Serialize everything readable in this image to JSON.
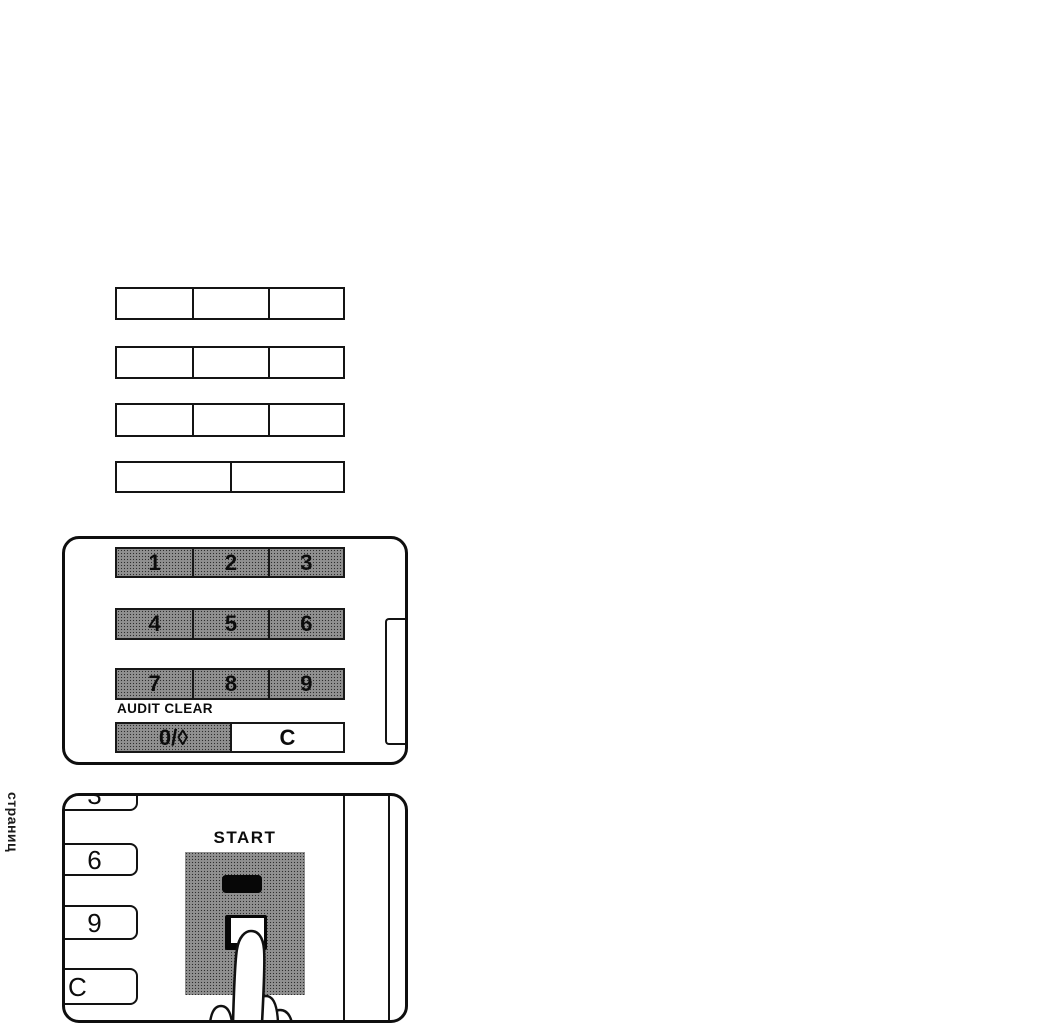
{
  "page": {
    "side_label": "страниц"
  },
  "blank_tables": {
    "rows": [
      {
        "cells": 3
      },
      {
        "cells": 3
      },
      {
        "cells": 3
      },
      {
        "cells": 2
      }
    ]
  },
  "keypad_panel": {
    "digits": [
      [
        "1",
        "2",
        "3"
      ],
      [
        "4",
        "5",
        "6"
      ],
      [
        "7",
        "8",
        "9"
      ]
    ],
    "audit_clear_label": "AUDIT CLEAR",
    "zero_key_label": "0/◊",
    "clear_key_label": "C"
  },
  "start_panel": {
    "title": "START",
    "side_keys": [
      "3",
      "6",
      "9",
      "C"
    ]
  },
  "colors": {
    "paper": "#ffffff",
    "ink": "#111111",
    "key_halftone_gray": "#c6c6c6",
    "indicator_black": "#070707"
  }
}
